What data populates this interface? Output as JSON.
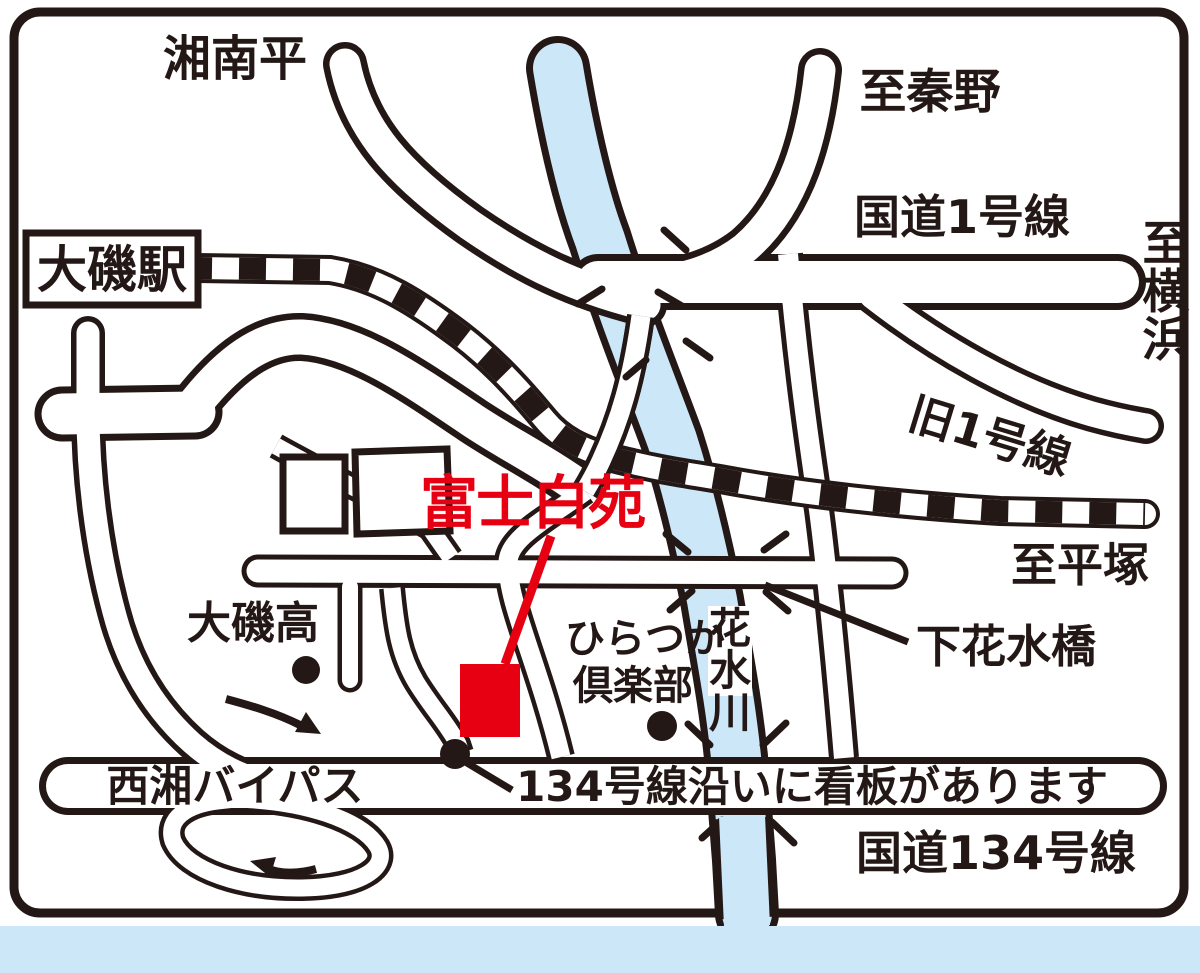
{
  "map": {
    "destination": {
      "name": "富士白苑",
      "marker": "red-square",
      "note_line_color": "#e60012"
    },
    "region_labels": {
      "shonandaira": "湘南平",
      "hadano": "至秦野",
      "route1": "国道1号線",
      "yokohama_chars": [
        "至",
        "横",
        "浜"
      ],
      "old_route1": "旧1号線",
      "to_hiratsuka": "至平塚",
      "station": "大磯駅",
      "shimohanamizu_bridge": "下花水橋",
      "highschool": "大磯高",
      "hiratsuka_club_lines": [
        "ひらつか",
        "倶楽部"
      ],
      "river_chars": [
        "花",
        "水",
        "川"
      ],
      "bypass": "西湘バイパス",
      "sign_note": "134号線沿いに看板があります",
      "route134": "国道134号線"
    },
    "colors": {
      "ink": "#231815",
      "water": "#cce7f8",
      "accent_red": "#e60012",
      "background": "#ffffff"
    }
  }
}
